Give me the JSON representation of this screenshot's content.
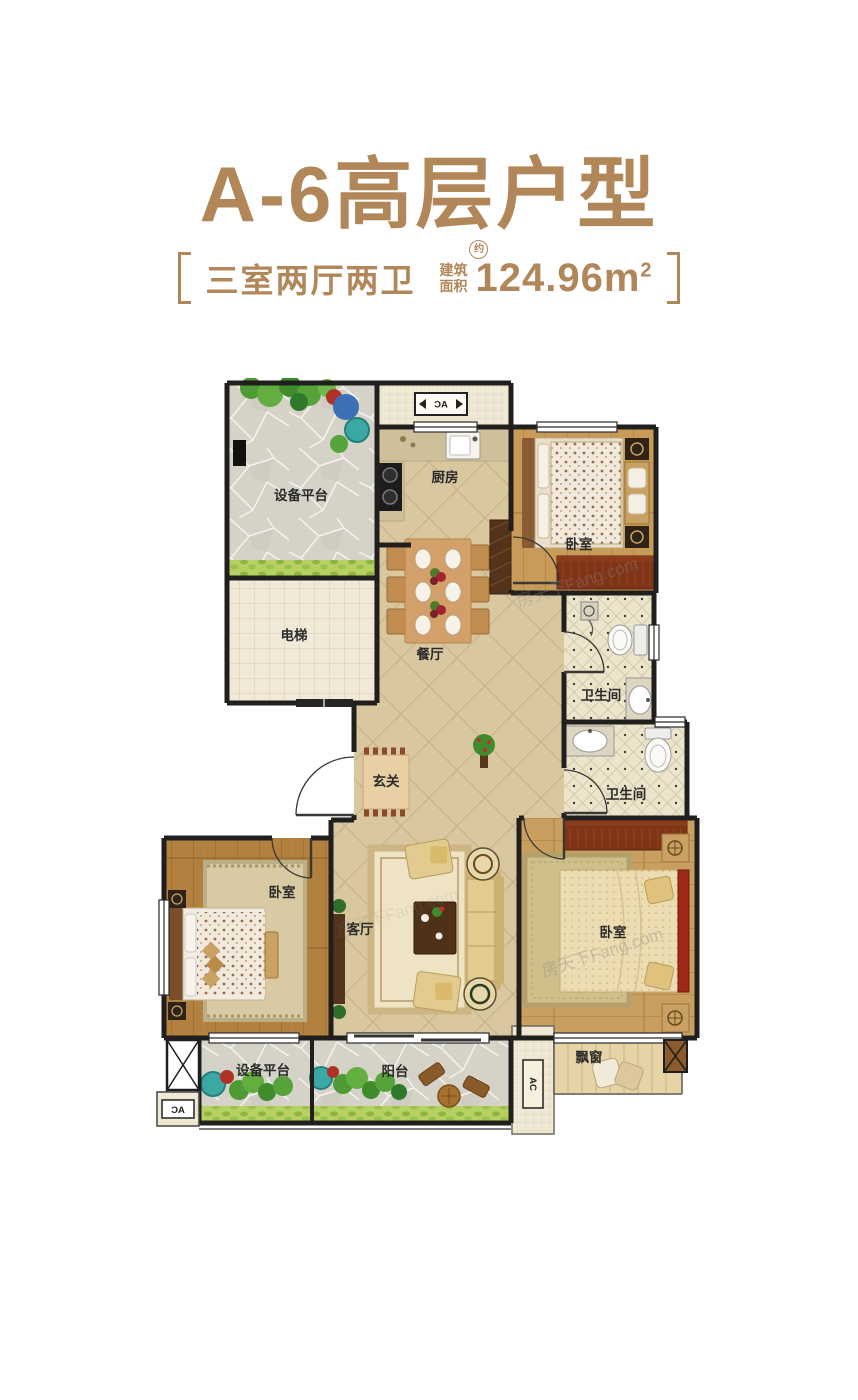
{
  "title": "A-6高层户型",
  "subtitle": {
    "layout": "三室两厅两卫",
    "area_label_l1": "建筑",
    "area_label_l2": "面积",
    "area_approx": "约",
    "area_value": "124.96m",
    "area_sup": "2"
  },
  "colors": {
    "brand_bronze": "#b1875a",
    "wall": "#201f1d",
    "floor_tile": "#d8c79f",
    "wood_mid": "#b3813f",
    "wood_light": "#c89b58",
    "paving_gray": "#d5d2c8",
    "dresser_red": "#7c3518",
    "headboard_red": "#a02818"
  },
  "floorplan": {
    "rooms": [
      {
        "id": "equip-top",
        "label": "设备平台"
      },
      {
        "id": "kitchen",
        "label": "厨房"
      },
      {
        "id": "bedroom-top",
        "label": "卧室"
      },
      {
        "id": "elevator",
        "label": "电梯"
      },
      {
        "id": "dining",
        "label": "餐厅"
      },
      {
        "id": "bath-top",
        "label": "卫生间"
      },
      {
        "id": "bath-bottom",
        "label": "卫生间"
      },
      {
        "id": "foyer",
        "label": "玄关"
      },
      {
        "id": "bedroom-left",
        "label": "卧室"
      },
      {
        "id": "living",
        "label": "客厅"
      },
      {
        "id": "bedroom-master",
        "label": "卧室"
      },
      {
        "id": "bay-window",
        "label": "飘窗"
      },
      {
        "id": "equip-bottom",
        "label": "设备平台"
      },
      {
        "id": "balcony",
        "label": "阳台"
      }
    ],
    "ac_label": "AC",
    "watermark": "房天下Fang.com"
  }
}
